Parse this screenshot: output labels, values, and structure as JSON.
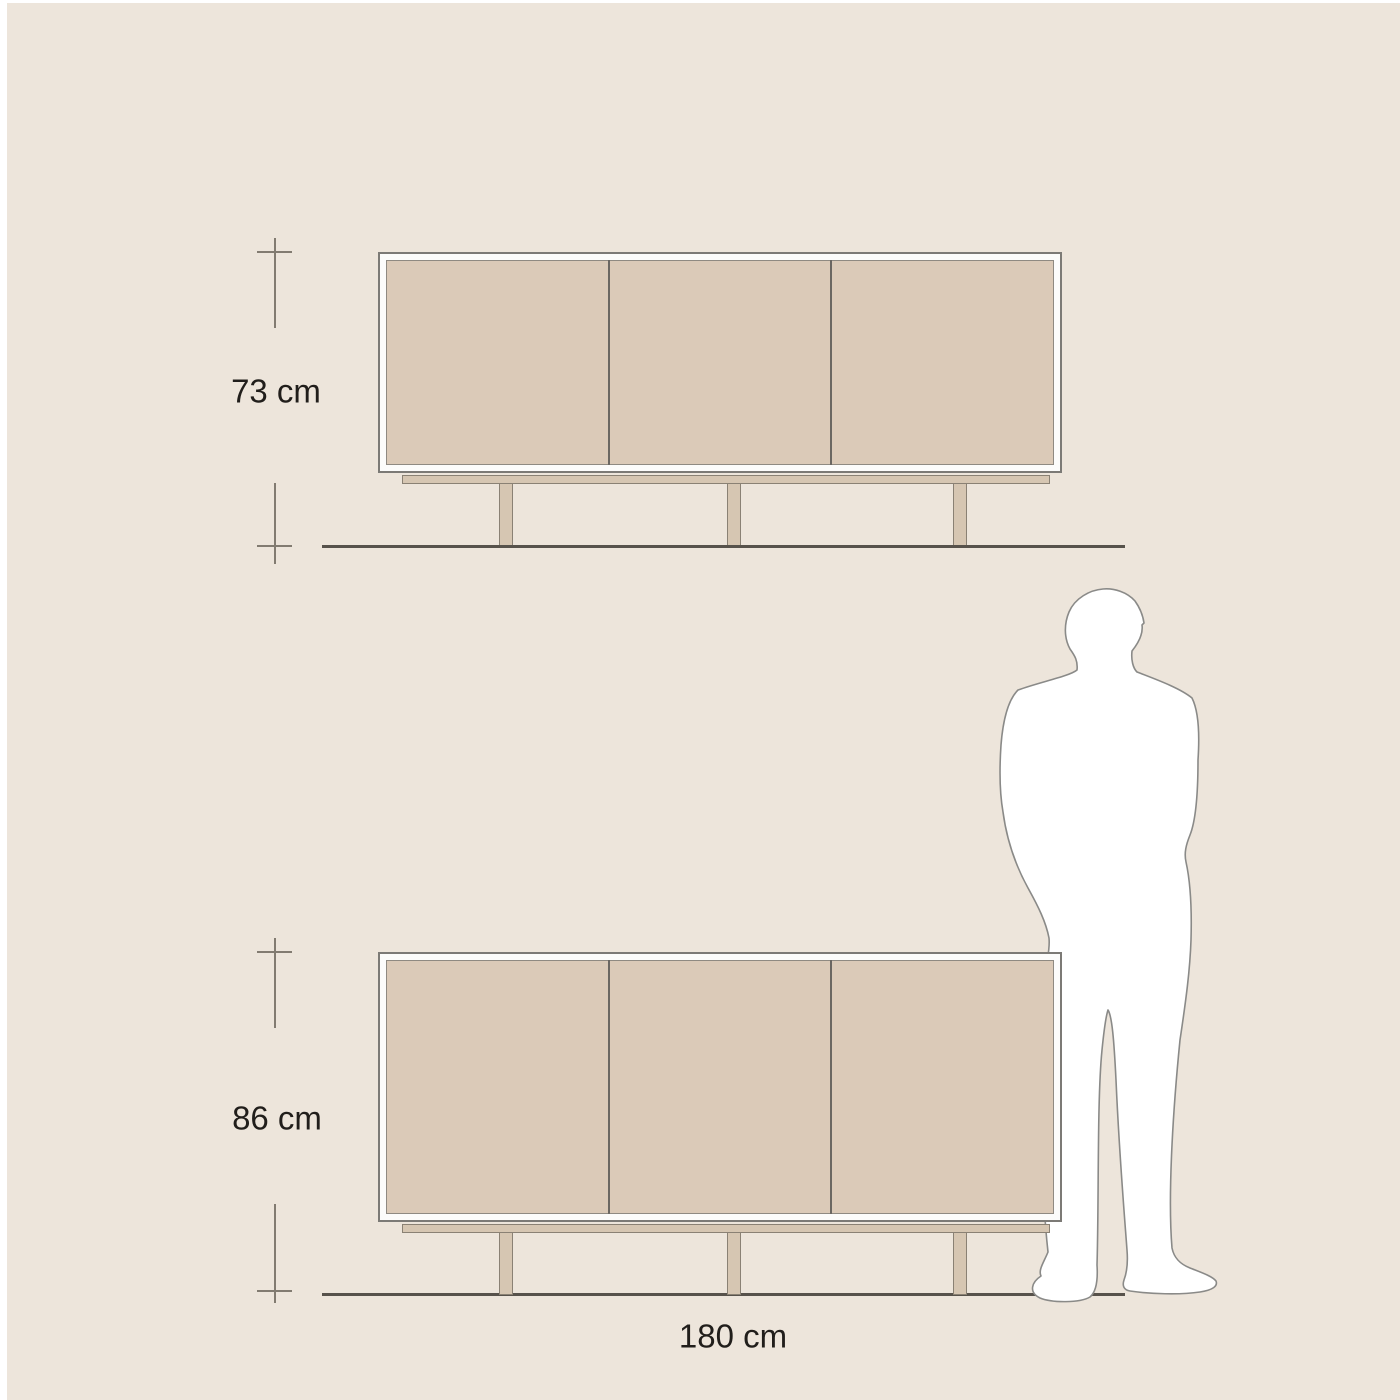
{
  "canvas": {
    "page_background": "#FFFFFF",
    "background": "#EDE5DB"
  },
  "diagrams": {
    "top": {
      "name": "sideboard front elevation, low version",
      "height_label": "73 cm",
      "door_count": 3
    },
    "bottom": {
      "name": "sideboard front elevation, high version, with scale figure",
      "height_label": "86 cm",
      "width_label": "180 cm",
      "door_count": 3
    }
  },
  "figure": {
    "icon": "man-silhouette",
    "fill": "#FFFFFF",
    "outline": "#8A8A88"
  },
  "colors": {
    "cabinet_frame_fill": "#FCFCFB",
    "cabinet_frame_border": "#7C7A76",
    "door_fill": "#DBCAB8",
    "door_border": "#8F8A82",
    "door_divider": "#6B6762",
    "base_fill": "#D6C6B2",
    "base_border": "#8A8174",
    "ground_line": "#57524B",
    "dimension_line": "#827B71",
    "label_text": "#211E1B"
  }
}
